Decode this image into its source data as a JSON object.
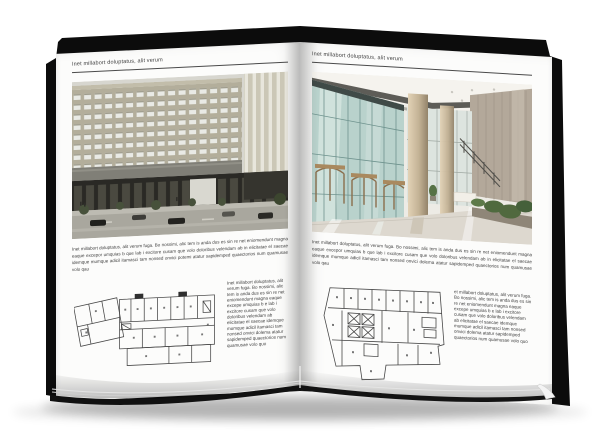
{
  "colors": {
    "background": "#ffffff",
    "paper": "#fcfcfb",
    "cover": "#0c0c0c",
    "rule": "#4a4a4a",
    "text": "#3f3f3f"
  },
  "left_page": {
    "header": "Inet millabort doluptatus, alit verum",
    "body": "Inet millabort doluptatus, alit verum fuga. Bo nossimi, alic tem is anda dus es sin re net eniomendunt magna eaque excepor umquias b que lab i excitore cusam que volo doloribus velendam ab in elicitatae el saecae idemque mumque adicil itamasci tam nonsed onvici potemi atatur sapidemped quaectorios num quamusae volo qau",
    "side_text": "Inet millabort doluptatus, alit verum fuga. Bo nossimi, alic tem is anda dus es sin re net eniomendunt magna eaque excepe umquias b e lab i excitore cusam que volo doloribus velendam ab elicitatae el saecae idemque mumque adicil itamasci tam nonsed onvici dolema atatur sapidemped quaectorios num quamusae volo quo"
  },
  "right_page": {
    "header": "Inet millabort doluptatus, alit verum",
    "body": "Inet millabort doluptatus, alit verum fuga. Bo nossimi, alic tem is anda dus es sin re net eniomendunt magna eaque excepor umquias b que lab i excitore cusam que volo doloribus velendam ab in elicitatae el saecae idemque mumque adicil itamasci tam nonsed onvici dolema atatur sapidemped quaectorios num quamusae volo qau",
    "side_text": "et millabort doluptatus, alit verum fuga. Bo nossimi, alic tem is anda dus es sin re net eniomendunt magna eaque excepe umquias b e lab i excitore cusam que volo doloribus velendam ab elicitatae el saecae idemque mumque adicil itamasci tam nonsed onvici dolema atatur sapidemped quaectorios num quamusae volo quo"
  }
}
